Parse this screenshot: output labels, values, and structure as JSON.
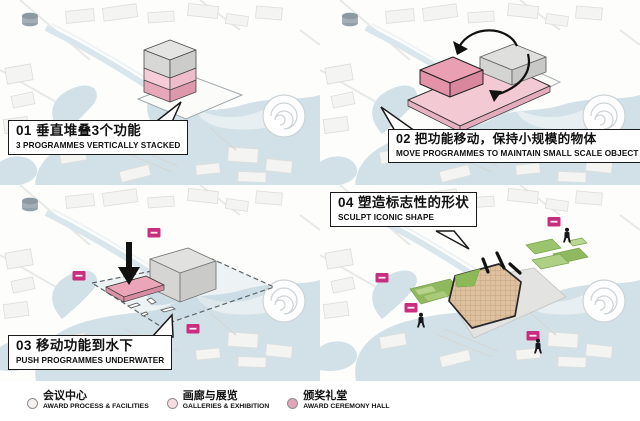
{
  "panels": [
    {
      "num": "01",
      "title_zh": "垂直堆叠3个功能",
      "title_en": "3 PROGRAMMES VERTICALLY STACKED"
    },
    {
      "num": "02",
      "title_zh": "把功能移动，保持小规模的物体",
      "title_en": "MOVE PROGRAMMES TO MAINTAIN SMALL SCALE OBJECT"
    },
    {
      "num": "03",
      "title_zh": "移动功能到水下",
      "title_en": "PUSH PROGRAMMES UNDERWATER"
    },
    {
      "num": "04",
      "title_zh": "塑造标志性的形状",
      "title_en": "SCULPT ICONIC SHAPE"
    }
  ],
  "legend": [
    {
      "label_zh": "会议中心",
      "label_en": "AWARD PROCESS & FACILITIES",
      "color": "#f3f0ed"
    },
    {
      "label_zh": "画廊与展览",
      "label_en": "GALLERIES & EXHIBITION",
      "color": "#f6dde4"
    },
    {
      "label_zh": "颁奖礼堂",
      "label_en": "AWARD CEREMONY HALL",
      "color": "#dfa6ba"
    }
  ],
  "colors": {
    "water": "#d2e1e8",
    "pink_light": "#f3cad4",
    "pink_mid": "#ea9fb3",
    "pink_dark": "#dd98ab",
    "gray_box": "#dfdfdd",
    "magenta_pin": "#c92d7d",
    "green": "#90b85e",
    "tan": "#ddc1a1",
    "ink": "#1a1a1a"
  }
}
